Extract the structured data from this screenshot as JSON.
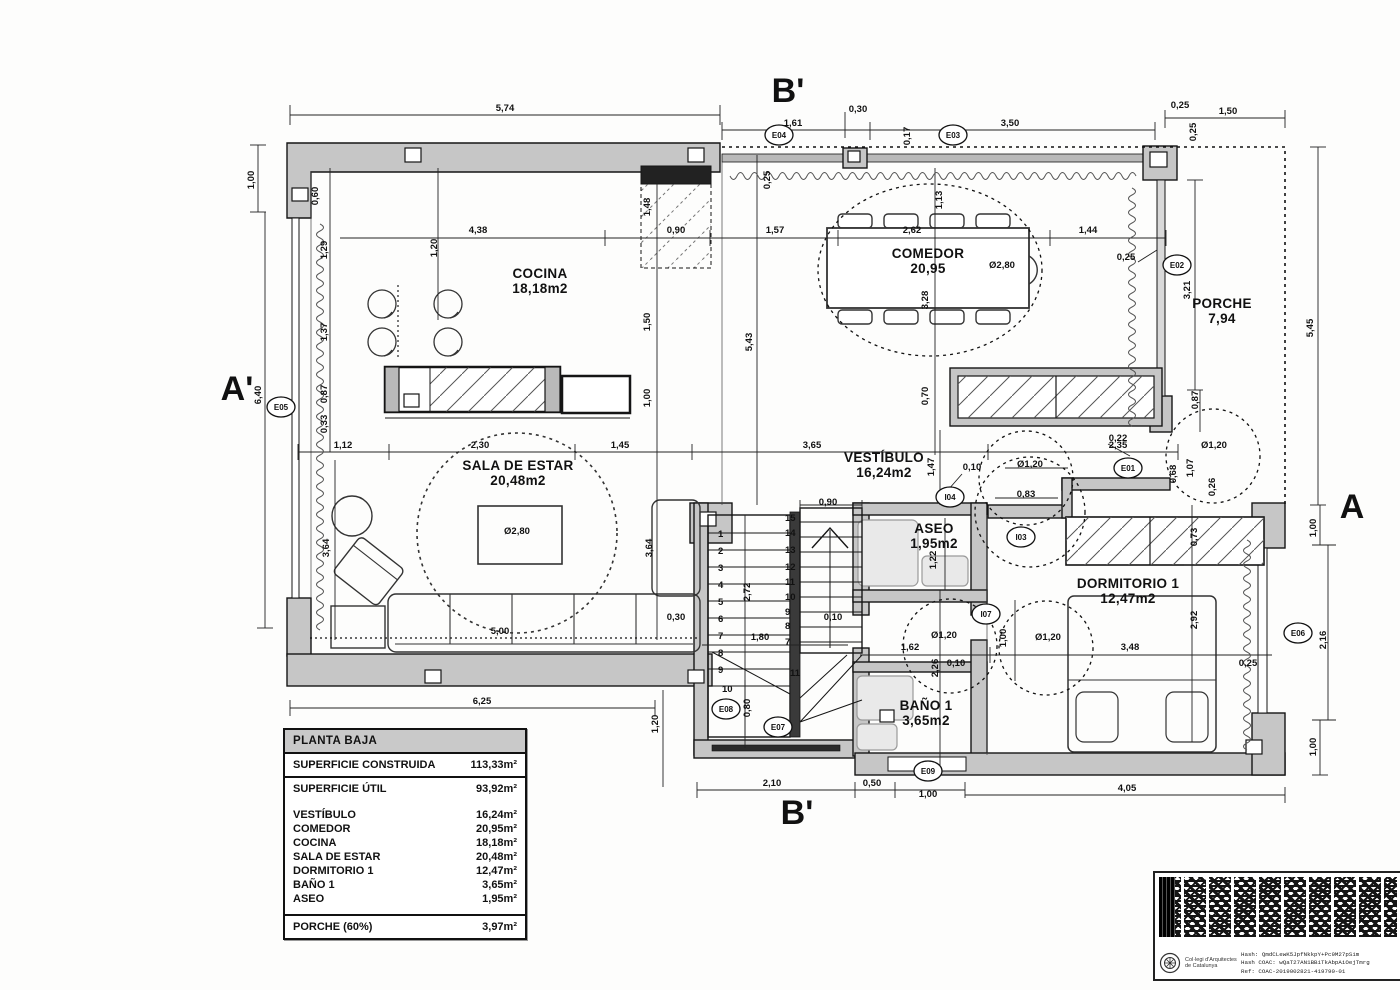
{
  "legend": {
    "title": "PLANTA BAJA",
    "construida_label": "SUPERFICIE CONSTRUIDA",
    "construida_value": "113,33m²",
    "util_label": "SUPERFICIE ÚTIL",
    "util_value": "93,92m²",
    "rooms": [
      {
        "label": "VESTÍBULO",
        "value": "16,24m²"
      },
      {
        "label": "COMEDOR",
        "value": "20,95m²"
      },
      {
        "label": "COCINA",
        "value": "18,18m²"
      },
      {
        "label": "SALA DE ESTAR",
        "value": "20,48m²"
      },
      {
        "label": "DORMITORIO 1",
        "value": "12,47m²"
      },
      {
        "label": "BAÑO 1",
        "value": "3,65m²"
      },
      {
        "label": "ASEO",
        "value": "1,95m²"
      }
    ],
    "porche_label": "PORCHE (60%)",
    "porche_value": "3,97m²"
  },
  "stamp": {
    "org_line1": "Col·legi d'Arquitectes",
    "org_line2": "de Catalunya",
    "hash1": "Hash: QmdCLewK5JpfNkkpY+Pc9M27pSim",
    "hash2": "Hash COAC: wQaT27AN1BBiTkAbpAiOejTmrg",
    "hash3": "Ref: COAC-2019002821-419790-01"
  },
  "plan": {
    "rooms": [
      {
        "name": "COCINA",
        "area": "18,18m2",
        "x": 540,
        "y": 278
      },
      {
        "name": "COMEDOR",
        "area": "20,95",
        "x": 928,
        "y": 258
      },
      {
        "name": "PORCHE",
        "area": "7,94",
        "x": 1222,
        "y": 308
      },
      {
        "name": "SALA DE ESTAR",
        "area": "20,48m2",
        "x": 518,
        "y": 470
      },
      {
        "name": "VESTÍBULO",
        "area": "16,24m2",
        "x": 884,
        "y": 462
      },
      {
        "name": "ASEO",
        "area": "1,95m2",
        "x": 934,
        "y": 533
      },
      {
        "name": "DORMITORIO 1",
        "area": "12,47m2",
        "x": 1128,
        "y": 588
      },
      {
        "name": "BAÑO 1",
        "area": "3,65m2",
        "x": 926,
        "y": 710
      }
    ],
    "sections": [
      {
        "t": "B'",
        "x": 788,
        "y": 102
      },
      {
        "t": "A'",
        "x": 237,
        "y": 400
      },
      {
        "t": "A",
        "x": 1352,
        "y": 518
      },
      {
        "t": "B'",
        "x": 797,
        "y": 824
      }
    ],
    "markers": [
      {
        "t": "E04",
        "x": 779,
        "y": 138
      },
      {
        "t": "E03",
        "x": 953,
        "y": 138
      },
      {
        "t": "E02",
        "x": 1177,
        "y": 268
      },
      {
        "t": "E05",
        "x": 281,
        "y": 410
      },
      {
        "t": "E01",
        "x": 1128,
        "y": 471
      },
      {
        "t": "E06",
        "x": 1298,
        "y": 636
      },
      {
        "t": "E08",
        "x": 726,
        "y": 712
      },
      {
        "t": "E07",
        "x": 778,
        "y": 730
      },
      {
        "t": "E09",
        "x": 928,
        "y": 774
      },
      {
        "t": "I04",
        "x": 950,
        "y": 500
      },
      {
        "t": "I03",
        "x": 1021,
        "y": 540
      },
      {
        "t": "I07",
        "x": 986,
        "y": 617
      }
    ],
    "stair_numbers": [
      {
        "t": "1",
        "x": 718,
        "y": 537
      },
      {
        "t": "2",
        "x": 718,
        "y": 554
      },
      {
        "t": "3",
        "x": 718,
        "y": 571
      },
      {
        "t": "4",
        "x": 718,
        "y": 588
      },
      {
        "t": "5",
        "x": 718,
        "y": 605
      },
      {
        "t": "6",
        "x": 718,
        "y": 622
      },
      {
        "t": "7",
        "x": 718,
        "y": 639
      },
      {
        "t": "8",
        "x": 718,
        "y": 656
      },
      {
        "t": "9",
        "x": 718,
        "y": 673
      },
      {
        "t": "10",
        "x": 722,
        "y": 692
      },
      {
        "t": "15",
        "x": 785,
        "y": 521
      },
      {
        "t": "14",
        "x": 785,
        "y": 536
      },
      {
        "t": "13",
        "x": 785,
        "y": 553
      },
      {
        "t": "12",
        "x": 785,
        "y": 570
      },
      {
        "t": "11",
        "x": 785,
        "y": 585
      },
      {
        "t": "10",
        "x": 785,
        "y": 600
      },
      {
        "t": "9",
        "x": 785,
        "y": 615
      },
      {
        "t": "8",
        "x": 785,
        "y": 629
      },
      {
        "t": "7",
        "x": 785,
        "y": 645
      },
      {
        "t": "11",
        "x": 790,
        "y": 676
      }
    ],
    "dims": [
      {
        "t": "5,74",
        "x": 505,
        "y": 111,
        "r": 0
      },
      {
        "t": "1,61",
        "x": 793,
        "y": 126,
        "r": 0
      },
      {
        "t": "0,30",
        "x": 858,
        "y": 112,
        "r": 0
      },
      {
        "t": "3,50",
        "x": 1010,
        "y": 126,
        "r": 0
      },
      {
        "t": "0,25",
        "x": 1180,
        "y": 108,
        "r": 0
      },
      {
        "t": "1,50",
        "x": 1228,
        "y": 114,
        "r": 0
      },
      {
        "t": "0,25",
        "x": 1196,
        "y": 132,
        "r": 1
      },
      {
        "t": "0,17",
        "x": 910,
        "y": 136,
        "r": 1
      },
      {
        "t": "0,25",
        "x": 770,
        "y": 180,
        "r": 1
      },
      {
        "t": "1,00",
        "x": 254,
        "y": 180,
        "r": 1
      },
      {
        "t": "6,40",
        "x": 261,
        "y": 395,
        "r": 1
      },
      {
        "t": "0,60",
        "x": 318,
        "y": 196,
        "r": 1
      },
      {
        "t": "1,29",
        "x": 327,
        "y": 250,
        "r": 1
      },
      {
        "t": "1,20",
        "x": 437,
        "y": 248,
        "r": 1
      },
      {
        "t": "1,37",
        "x": 327,
        "y": 332,
        "r": 1
      },
      {
        "t": "0,87",
        "x": 327,
        "y": 394,
        "r": 1
      },
      {
        "t": "0,33",
        "x": 327,
        "y": 424,
        "r": 1
      },
      {
        "t": "4,38",
        "x": 478,
        "y": 233,
        "r": 0
      },
      {
        "t": "0,90",
        "x": 676,
        "y": 233,
        "r": 0
      },
      {
        "t": "1,57",
        "x": 775,
        "y": 233,
        "r": 0
      },
      {
        "t": "2,62",
        "x": 912,
        "y": 233,
        "r": 0
      },
      {
        "t": "1,44",
        "x": 1088,
        "y": 233,
        "r": 0
      },
      {
        "t": "1,48",
        "x": 650,
        "y": 207,
        "r": 1
      },
      {
        "t": "1,50",
        "x": 650,
        "y": 322,
        "r": 1
      },
      {
        "t": "1,00",
        "x": 650,
        "y": 398,
        "r": 1
      },
      {
        "t": "5,43",
        "x": 752,
        "y": 342,
        "r": 1
      },
      {
        "t": "1,13",
        "x": 942,
        "y": 200,
        "r": 1
      },
      {
        "t": "3,28",
        "x": 928,
        "y": 300,
        "r": 1
      },
      {
        "t": "0,70",
        "x": 928,
        "y": 396,
        "r": 1
      },
      {
        "t": "Ø2,80",
        "x": 1002,
        "y": 268,
        "r": 0
      },
      {
        "t": "0,25",
        "x": 1126,
        "y": 260,
        "r": 0
      },
      {
        "t": "3,21",
        "x": 1190,
        "y": 290,
        "r": 1
      },
      {
        "t": "5,45",
        "x": 1313,
        "y": 328,
        "r": 1
      },
      {
        "t": "0,87",
        "x": 1198,
        "y": 400,
        "r": 1
      },
      {
        "t": "1,12",
        "x": 343,
        "y": 448,
        "r": 0
      },
      {
        "t": "2,30",
        "x": 480,
        "y": 448,
        "r": 0
      },
      {
        "t": "1,45",
        "x": 620,
        "y": 448,
        "r": 0
      },
      {
        "t": "3,65",
        "x": 812,
        "y": 448,
        "r": 0
      },
      {
        "t": "2,35",
        "x": 1118,
        "y": 448,
        "r": 0
      },
      {
        "t": "0,10",
        "x": 972,
        "y": 470,
        "r": 0
      },
      {
        "t": "Ø1,20",
        "x": 1030,
        "y": 467,
        "r": 0
      },
      {
        "t": "0,83",
        "x": 1026,
        "y": 497,
        "r": 0
      },
      {
        "t": "1,47",
        "x": 934,
        "y": 467,
        "r": 1
      },
      {
        "t": "0,22",
        "x": 1118,
        "y": 441,
        "r": 0
      },
      {
        "t": "Ø1,20",
        "x": 1214,
        "y": 448,
        "r": 0
      },
      {
        "t": "0,68",
        "x": 1176,
        "y": 474,
        "r": 1
      },
      {
        "t": "1,07",
        "x": 1193,
        "y": 468,
        "r": 1
      },
      {
        "t": "0,26",
        "x": 1215,
        "y": 487,
        "r": 1
      },
      {
        "t": "3,64",
        "x": 329,
        "y": 548,
        "r": 1
      },
      {
        "t": "3,64",
        "x": 652,
        "y": 548,
        "r": 1
      },
      {
        "t": "Ø2,80",
        "x": 517,
        "y": 534,
        "r": 0
      },
      {
        "t": "5,00",
        "x": 500,
        "y": 634,
        "r": 0
      },
      {
        "t": "0,30",
        "x": 676,
        "y": 620,
        "r": 0
      },
      {
        "t": "0,90",
        "x": 828,
        "y": 505,
        "r": 0
      },
      {
        "t": "2,72",
        "x": 750,
        "y": 592,
        "r": 1
      },
      {
        "t": "1,80",
        "x": 760,
        "y": 640,
        "r": 0
      },
      {
        "t": "0,80",
        "x": 750,
        "y": 708,
        "r": 1
      },
      {
        "t": "0,10",
        "x": 833,
        "y": 620,
        "r": 0
      },
      {
        "t": "1,22",
        "x": 936,
        "y": 560,
        "r": 1
      },
      {
        "t": "1,62",
        "x": 910,
        "y": 650,
        "r": 0
      },
      {
        "t": "2,26",
        "x": 938,
        "y": 668,
        "r": 1
      },
      {
        "t": "0,10",
        "x": 956,
        "y": 666,
        "r": 0
      },
      {
        "t": "Ø1,20",
        "x": 944,
        "y": 638,
        "r": 0
      },
      {
        "t": "1,00",
        "x": 1006,
        "y": 638,
        "r": 1
      },
      {
        "t": "Ø1,20",
        "x": 1048,
        "y": 640,
        "r": 0
      },
      {
        "t": "3,48",
        "x": 1130,
        "y": 650,
        "r": 0
      },
      {
        "t": "0,73",
        "x": 1197,
        "y": 537,
        "r": 1
      },
      {
        "t": "2,92",
        "x": 1197,
        "y": 620,
        "r": 1
      },
      {
        "t": "0,25",
        "x": 1248,
        "y": 666,
        "r": 0
      },
      {
        "t": "1,00",
        "x": 1316,
        "y": 528,
        "r": 1
      },
      {
        "t": "2,16",
        "x": 1326,
        "y": 640,
        "r": 1
      },
      {
        "t": "1,00",
        "x": 1316,
        "y": 747,
        "r": 1
      },
      {
        "t": "6,25",
        "x": 482,
        "y": 704,
        "r": 0
      },
      {
        "t": "1,20",
        "x": 658,
        "y": 724,
        "r": 1
      },
      {
        "t": "2,10",
        "x": 772,
        "y": 786,
        "r": 0
      },
      {
        "t": "0,50",
        "x": 872,
        "y": 786,
        "r": 0
      },
      {
        "t": "1,00",
        "x": 928,
        "y": 797,
        "r": 0
      },
      {
        "t": "4,05",
        "x": 1127,
        "y": 791,
        "r": 0
      }
    ]
  }
}
